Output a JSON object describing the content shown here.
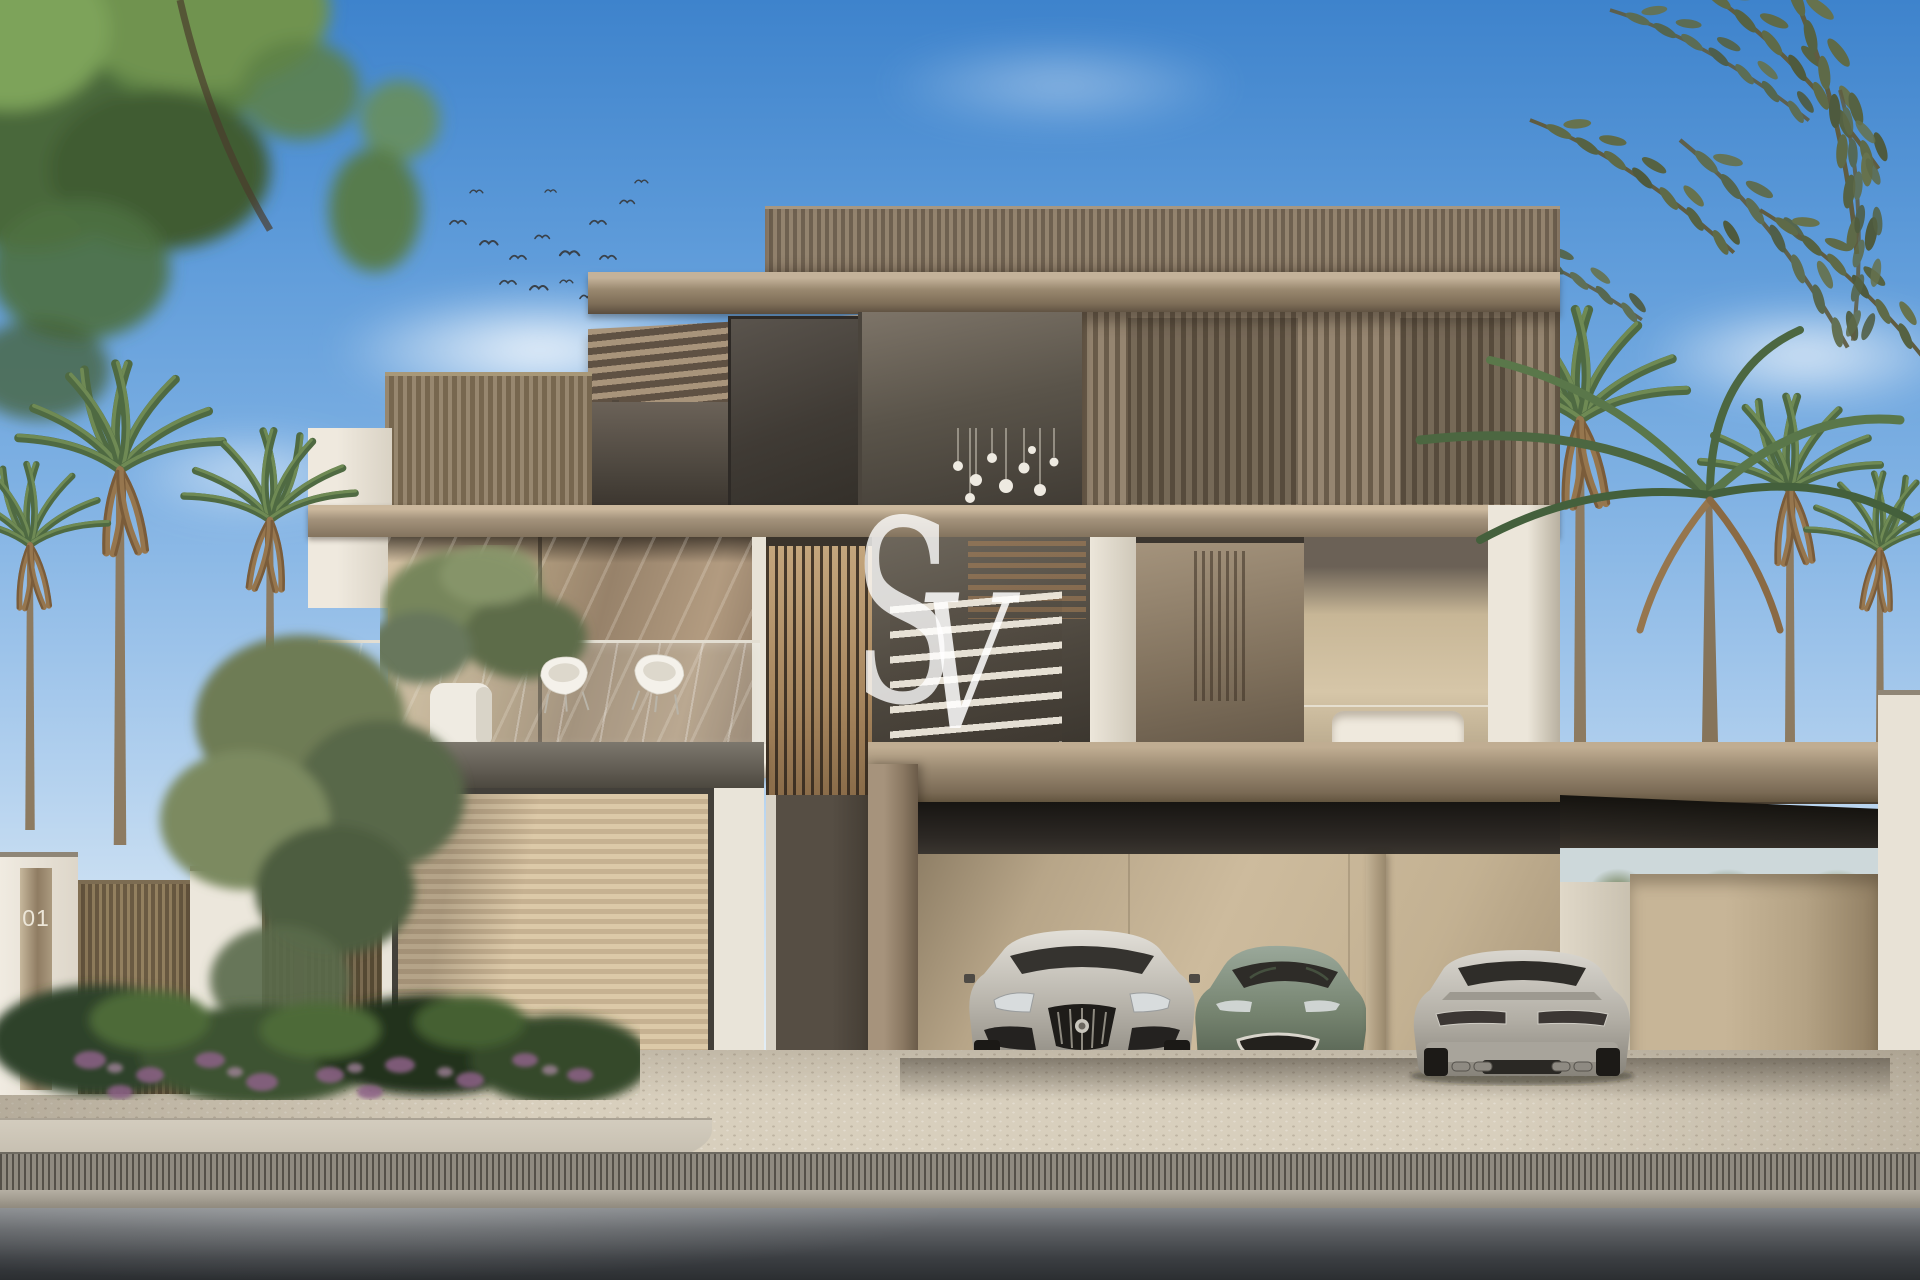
{
  "scene": {
    "description": "Daylight front-elevation render of a modern two-storey luxury villa with slatted timber facades, glass balcony, pergola roof canopy, landscaped garden with palms and purple flowering shrubs, and a carport with three cars",
    "sky": "clear blue sky with wispy clouds and a flock of birds",
    "time_of_day": "day"
  },
  "watermark": {
    "s": "S",
    "v": "V",
    "style": "translucent white serif monogram overlay"
  },
  "signage": {
    "gate_number": "01"
  },
  "vehicles": [
    {
      "position": "left bay",
      "view": "front",
      "color_name": "silver",
      "hex": "#b5b1a9"
    },
    {
      "position": "middle bay",
      "view": "front three-quarter",
      "color_name": "sage green",
      "hex": "#7a8678"
    },
    {
      "position": "right bay",
      "view": "rear",
      "color_name": "silver",
      "hex": "#b3afa7"
    }
  ],
  "palette": {
    "sky_top": "#3e83cc",
    "sky_horizon": "#eef4f7",
    "timber_light": "#a5937e",
    "timber_dark": "#6e604d",
    "stone_white": "#ece6da",
    "glass_warm": "#c9b59b",
    "soffit_dark": "#2c2824",
    "garage_wall": "#cdbb9d",
    "paver": "#d8cfbd",
    "road_dark": "#2b2e31",
    "foliage_green": "#5f7f42",
    "palm_dry": "#9a7c52",
    "flower_purple": "#8e6288"
  }
}
